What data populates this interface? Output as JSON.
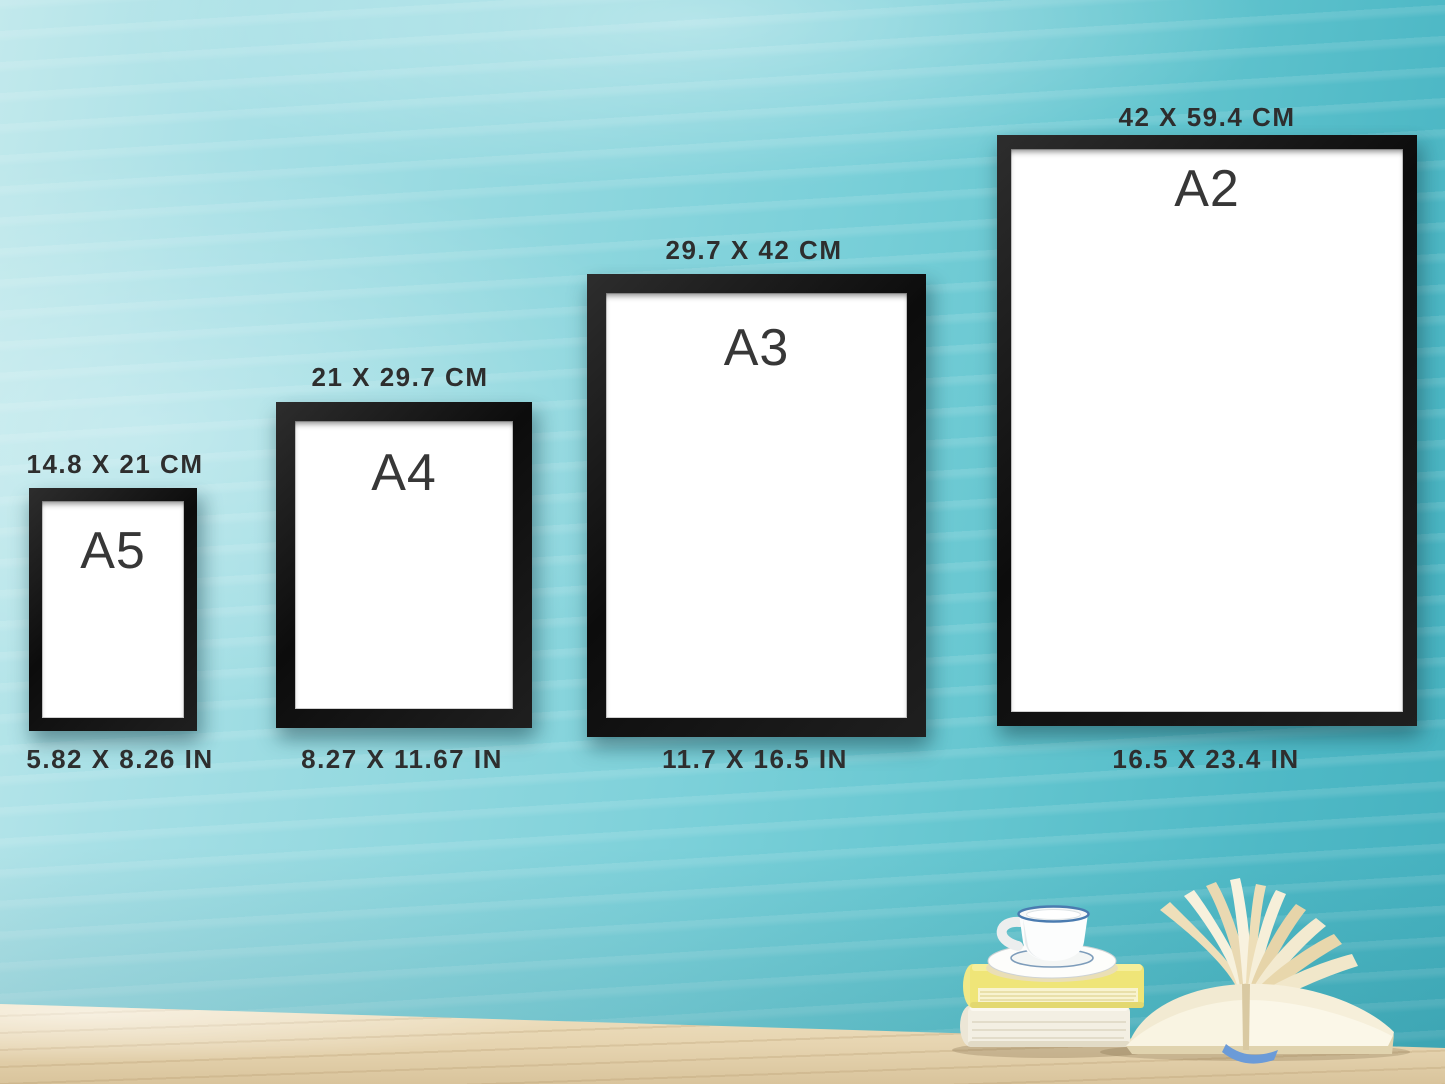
{
  "frames": [
    {
      "code": "A5",
      "cm": "14.8 X 21 CM",
      "in": "5.82 X 8.26 IN"
    },
    {
      "code": "A4",
      "cm": "21 X 29.7 CM",
      "in": "8.27 X 11.67 IN"
    },
    {
      "code": "A3",
      "cm": "29.7 X 42 CM",
      "in": "11.7 X 16.5 IN"
    },
    {
      "code": "A2",
      "cm": "42 X 59.4 CM",
      "in": "16.5 X 23.4 IN"
    }
  ],
  "decor": {
    "items": [
      "coffee-cup-on-saucer",
      "yellow-book",
      "cream-book",
      "open-book",
      "wooden-table"
    ]
  },
  "colors": {
    "wall_light": "#c2e9ec",
    "wall_mid": "#7bd0d9",
    "wall_deep": "#45b1bf",
    "frame": "#161616",
    "paper": "#ffffff",
    "text": "#2e2e2e",
    "table_light": "#f0e2c2",
    "table_dark": "#d9c49c",
    "book_yellow": "#efe578",
    "book_cream": "#f3efe3",
    "cup_stripe": "#4a7bb0",
    "bookmark_blue": "#6b9bd8"
  }
}
